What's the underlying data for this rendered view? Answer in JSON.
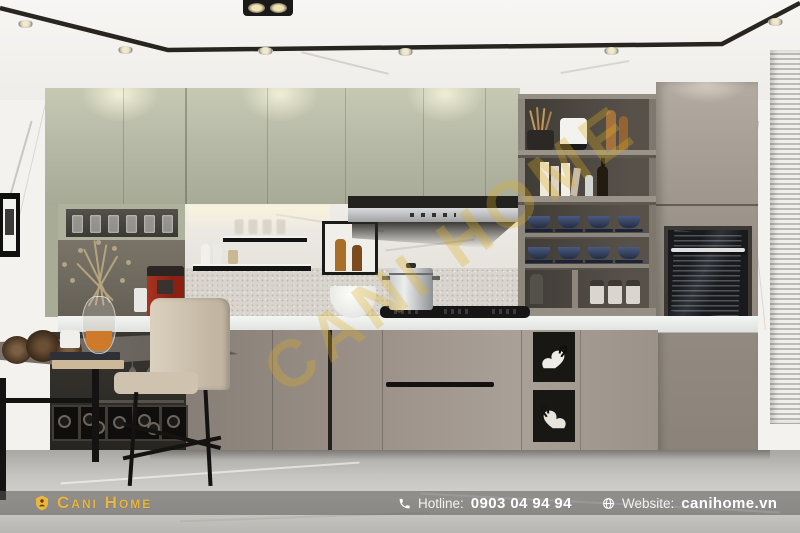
{
  "brand": {
    "logo_text": "Cani Home",
    "gold": "#ECB63E"
  },
  "watermark": {
    "text": "CANI HOME",
    "color_rgba": "rgba(222,174,32,0.30)"
  },
  "footer_bar": {
    "hotline_label": "Hotline:",
    "hotline_number": "0903 04 94 94",
    "website_label": "Website:",
    "website_domain": "canihome.vn",
    "background_rgba": "rgba(90,88,85,0.55)",
    "text_color": "#FFFFFF"
  },
  "icons": [
    "logo-shield-icon",
    "phone-icon",
    "globe-icon"
  ],
  "palette": {
    "ceiling_white": "#F6F5F3",
    "wall_marble_white": "#F4F2EF",
    "upper_cabinet_sage": "#B9BCA8",
    "tall_cabinet_taupe": "#978F85",
    "base_cabinet_taupe": "#9A928A",
    "shelf_unit_charcoal": "#44403A",
    "countertop_white": "#EEF0EE",
    "hood_steel": "#C3C4C6",
    "floor_marble_gray": "#C6C4C0",
    "coffee_machine_red": "#9C2718",
    "chair_beige": "#D2C7B4",
    "ceiling_trim_black": "#17120E"
  }
}
